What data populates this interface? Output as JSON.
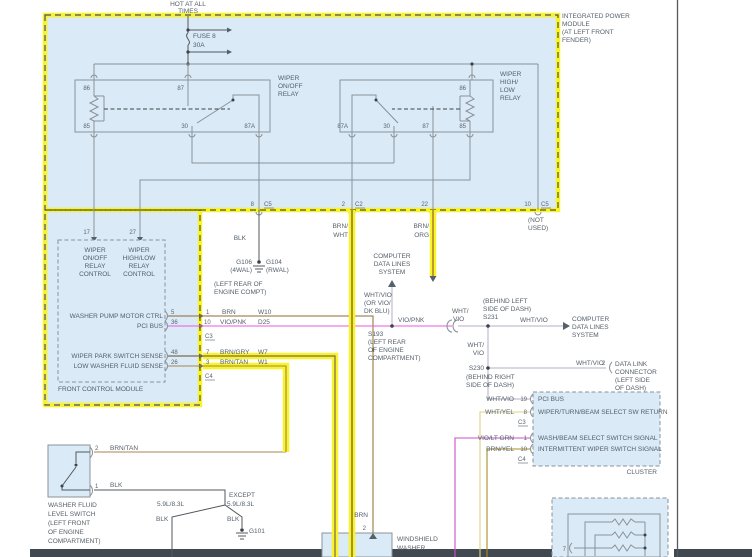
{
  "window": {
    "width": 752,
    "height": 557
  },
  "colors": {
    "highlight_yellow": "#f8f32b",
    "module_fill": "#daeaf6",
    "border_gray": "#8b939b",
    "text": "#55606b",
    "wire_gray": "#8a9199",
    "blk": "#53585e",
    "brn": "#8f6b32",
    "brn_wht": "#6f5524",
    "brn_org": "#96622a",
    "brn_tan": "#a5854f",
    "brn_gry": "#7c6a52",
    "vio_pnk": "#ee55e2",
    "wht_vio": "#b5aec6",
    "wht_yel": "#ddd37f",
    "vio_lt_grn": "#cc4fcc",
    "brn_yel": "#ab8c22",
    "bottom_band": "#42484f"
  },
  "power": {
    "hot1": "HOT AT ALL",
    "hot2": "TIMES",
    "fuse_name": "FUSE 8",
    "fuse_rating": "30A"
  },
  "ipm": {
    "name": [
      "INTEGRATED POWER",
      "MODULE",
      "(AT LEFT FRONT",
      "FENDER)"
    ],
    "relay_onoff": {
      "name": [
        "WIPER",
        "ON/OFF",
        "RELAY"
      ],
      "p86": "86",
      "p87": "87",
      "p85": "85",
      "p30": "30",
      "p87a": "87A"
    },
    "relay_highlow": {
      "name": [
        "WIPER",
        "HIGH/",
        "LOW",
        "RELAY"
      ],
      "p86": "86",
      "p85": "85",
      "p87a": "87A",
      "p30": "30",
      "p87": "87"
    },
    "out8": {
      "pin": "8",
      "conn": "C5",
      "wire": "BLK"
    },
    "out2": {
      "pin": "2",
      "conn": "C2",
      "wire1": "BRN/",
      "wire2": "WHT"
    },
    "out22": {
      "pin": "22",
      "wire1": "BRN/",
      "wire2": "ORG"
    },
    "out10": {
      "pin": "10",
      "conn": "C5",
      "note1": "(NOT",
      "note2": "USED)"
    }
  },
  "grounds": {
    "g_left": "G106",
    "g_left_note": "(4WAL)",
    "g_right": "G104",
    "g_right_note": "(RWAL)",
    "loc1": "(LEFT REAR OF",
    "loc2": "ENGINE COMPT)",
    "g101": "G101"
  },
  "fcm": {
    "name": "FRONT CONTROL MODULE",
    "p17": "17",
    "p27": "27",
    "ctrl1": [
      "WIPER",
      "ON/OFF",
      "RELAY",
      "CONTROL"
    ],
    "ctrl2": [
      "WIPER",
      "HIGH/LOW",
      "RELAY",
      "CONTROL"
    ],
    "rows": [
      {
        "label": "WASHER PUMP MOTOR CTRL",
        "pin": "5",
        "ext": "1",
        "wire": "BRN",
        "circuit": "W10"
      },
      {
        "label": "PCI BUS",
        "pin": "36",
        "ext": "10",
        "wire": "VIO/PNK",
        "circuit": "D25"
      },
      {
        "label": "WIPER PARK SWITCH SENSE",
        "pin": "48",
        "ext": "7",
        "wire": "BRN/GRY",
        "circuit": "W7"
      },
      {
        "label": "LOW WASHER FLUID SENSE",
        "pin": "26",
        "ext": "3",
        "wire": "BRN/TAN",
        "circuit": "W1"
      }
    ],
    "c3": "C3",
    "c4": "C4"
  },
  "bus": {
    "cdl_top": [
      "COMPUTER",
      "DATA LINES",
      "SYSTEM"
    ],
    "alt": [
      "WHT/VIO",
      "(OR VIO/",
      "DK BLU)"
    ],
    "vio_pnk": "VIO/PNK",
    "s193": "S193",
    "s193_loc": [
      "(LEFT REAR",
      "OF ENGINE",
      "COMPARTMENT)"
    ],
    "whtvio_a": "WHT/",
    "whtvio_b": "VIO",
    "s231": "S231",
    "s231_loc": [
      "(BEHIND LEFT",
      "SIDE OF DASH)"
    ],
    "whtvio_right": "WHT/VIO",
    "cdl_right": [
      "COMPUTER",
      "DATA LINES",
      "SYSTEM"
    ],
    "down_a": "WHT/",
    "down_b": "VIO",
    "s230": "S230",
    "s230_loc": [
      "(BEHIND RIGHT",
      "SIDE OF DASH)"
    ],
    "dlc_wire": "WHT/VIO",
    "dlc_pin": "2",
    "dlc": [
      "DATA LINK",
      "CONNECTOR",
      "(LEFT SIDE",
      "OF DASH)"
    ]
  },
  "cluster": {
    "name": "CLUSTER",
    "c3": "C3",
    "c4": "C4",
    "rows": [
      {
        "wire": "WHT/VIO",
        "pin": "19",
        "label": "PCI BUS"
      },
      {
        "wire": "WHT/YEL",
        "pin": "8",
        "label": "WIPER/TURN/BEAM SELECT SW RETURN"
      },
      {
        "wire": "VIO/LT GRN",
        "pin": "1",
        "label": "WASH/BEAM SELECT SWITCH SIGNAL"
      },
      {
        "wire": "BRN/YEL",
        "pin": "10",
        "label": "INTERMITTENT WIPER SWITCH SIGNAL"
      }
    ]
  },
  "washer_switch": {
    "name": [
      "WASHER FLUID",
      "LEVEL SWITCH",
      "(LEFT FRONT",
      "OF ENGINE",
      "COMPARTMENT)"
    ],
    "p2": "2",
    "p1": "1",
    "wire_top": "BRN/TAN",
    "wire_bottom": "BLK",
    "branch_left": "5.9L/8.3L",
    "branch_right1": "EXCEPT",
    "branch_right2": "5.9L/8.3L",
    "blk_left": "BLK",
    "blk_right": "BLK"
  },
  "washer_pump": {
    "pin": "2",
    "wire": "BRN",
    "name1": "WINDSHIELD",
    "name2": "WASHER"
  },
  "mfs": {
    "pin7": "7"
  }
}
